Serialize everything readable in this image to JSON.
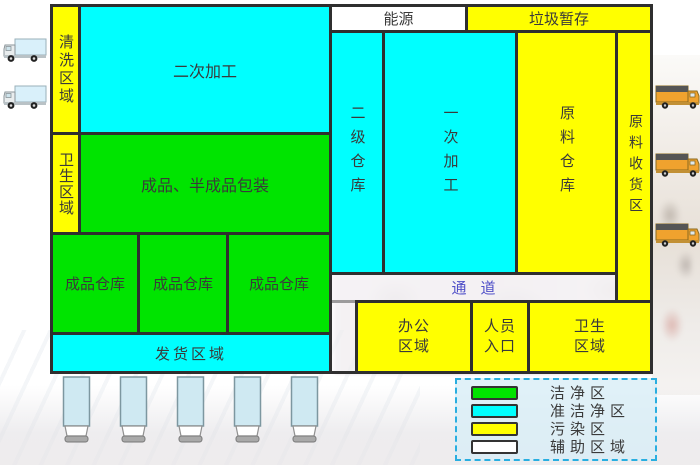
{
  "diagram_title": "factory-zoning-layout",
  "colors": {
    "clean": "#00e400",
    "quasi_clean": "#00ffff",
    "polluted": "#ffff00",
    "auxiliary": "#ffffff",
    "border": "#2f2f2f",
    "corridor_text": "#5050c8",
    "legend_border": "#29aee0"
  },
  "zones": {
    "cleaning": {
      "label": "清洗区域",
      "category": "污染区"
    },
    "secondary_processing": {
      "label": "二次加工",
      "category": "准洁净区"
    },
    "energy": {
      "label": "能源",
      "category": "辅助区域"
    },
    "waste_storage": {
      "label": "垃圾暂存",
      "category": "污染区"
    },
    "hygiene_left": {
      "label": "卫生区域",
      "category": "污染区"
    },
    "packaging": {
      "label": "成品、半成品包装",
      "category": "洁净区"
    },
    "secondary_warehouse": {
      "label": "二级仓库",
      "category": "准洁净区"
    },
    "primary_processing": {
      "label": "一次加工",
      "category": "准洁净区"
    },
    "raw_warehouse": {
      "label": "原料仓库",
      "category": "污染区"
    },
    "raw_receiving": {
      "label": "原料收货区",
      "category": "污染区"
    },
    "finished_warehouse_1": {
      "label": "成品仓库",
      "category": "洁净区"
    },
    "finished_warehouse_2": {
      "label": "成品仓库",
      "category": "洁净区"
    },
    "finished_warehouse_3": {
      "label": "成品仓库",
      "category": "洁净区"
    },
    "shipping": {
      "label": "发货区域",
      "category": "准洁净区"
    },
    "corridor": {
      "label": "通道",
      "category": "辅助区域"
    },
    "office": {
      "label": "办公区域",
      "category": "污染区"
    },
    "staff_entrance": {
      "label": "人员入口",
      "category": "污染区"
    },
    "hygiene_bottom": {
      "label": "卫生区域",
      "category": "污染区"
    }
  },
  "legend": {
    "items": [
      {
        "label": "洁净区",
        "color": "#00e400"
      },
      {
        "label": "准洁净区",
        "color": "#00ffff"
      },
      {
        "label": "污染区",
        "color": "#ffff00"
      },
      {
        "label": "辅助区域",
        "color": "#ffffff"
      }
    ]
  },
  "icons": {
    "left_truck": "box-truck-left-icon",
    "right_truck": "box-truck-right-icon",
    "dock": "loading-dock-icon"
  }
}
